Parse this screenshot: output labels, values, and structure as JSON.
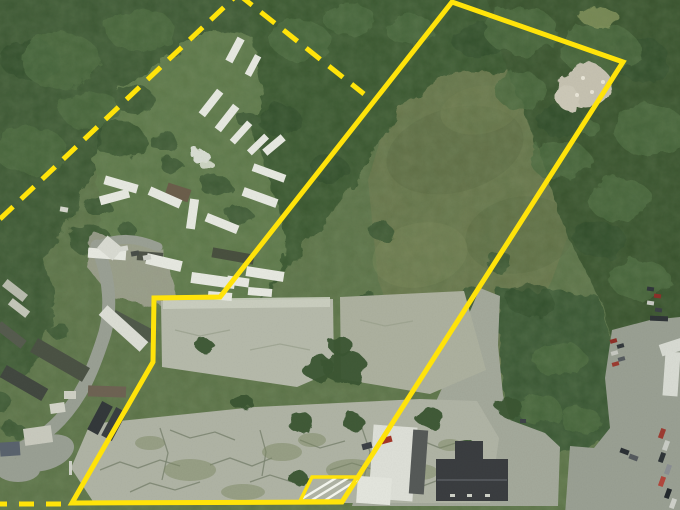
{
  "meta": {
    "width": 680,
    "height": 510,
    "description_name": "aerial-parcel-map"
  },
  "palette": {
    "base_grass": "#5e7449",
    "field_olive": "#6a774c",
    "forest": "#3a5733",
    "forest_dark": "#2c4728",
    "clearing": "#617a4c",
    "pavement_light": "#b6baab",
    "pavement_mid": "#adb19f",
    "pavement_cracked": "#b0b4a5",
    "driveway": "#a4a99b",
    "parking": "#9aa093",
    "road": "#9aa094",
    "boundary_yellow": "#ffe30a",
    "hatch_white": "#f3f5ed",
    "trailer_white": "#e7e9e1",
    "building_dark_roof": "#3a3d40",
    "crack": "#79826e",
    "moss": "#7d8966"
  },
  "scene": {
    "terrain": [
      {
        "name": "field-meadow",
        "pts": "368,180 390,108 445,68 555,66 602,100 588,180 552,280 512,360 478,412 448,398 408,360 378,280",
        "fill": "#6a774c",
        "rough": false,
        "op": 1
      }
    ],
    "field_patches": [
      [
        455,
        150,
        70,
        42,
        -15,
        "#5d6b43",
        0.55
      ],
      [
        520,
        235,
        55,
        38,
        -10,
        "#5a6a42",
        0.45
      ],
      [
        420,
        255,
        48,
        32,
        -12,
        "#788556",
        0.5
      ],
      [
        470,
        330,
        40,
        26,
        -8,
        "#61704a",
        0.5
      ],
      [
        480,
        110,
        40,
        24,
        -10,
        "#717d50",
        0.5
      ]
    ],
    "forest": [
      {
        "name": "forest-top-left",
        "pts": "-20,-20 265,-20 250,40 180,62 150,112 92,170 58,240 28,282 -20,292",
        "fill": "#3a5733"
      },
      {
        "name": "forest-center-band",
        "pts": "250,-20 505,-20 560,28 610,58 600,105 550,70 448,72 400,110 362,170 322,228 285,272 252,302 227,283 246,195 254,118 250,55",
        "fill": "#38552f"
      },
      {
        "name": "forest-right",
        "pts": "480,-20 700,-20 700,322 640,328 612,342 600,300 565,230 535,140 505,60",
        "fill": "#34502c"
      },
      {
        "name": "forest-right-lower",
        "pts": "497,288 598,296 612,345 612,430 588,450 548,452 512,432 500,360",
        "fill": "#375430"
      },
      {
        "name": "forest-left-edge",
        "pts": "-20,240 42,252 56,300 40,360 14,382 -20,372",
        "fill": "#3a5733"
      },
      {
        "name": "clearing-trailer-yard",
        "pts": "120,88 175,52 215,30 252,36 262,92 250,130 268,175 285,235 282,272 248,300 180,308 118,295 95,252 102,205 92,158 108,120",
        "fill": "#617a4c"
      }
    ],
    "canopy_dark": [
      [
        30,
        60,
        30,
        20
      ],
      [
        120,
        140,
        26,
        18
      ],
      [
        480,
        40,
        28,
        18
      ],
      [
        640,
        60,
        30,
        22
      ],
      [
        600,
        240,
        26,
        18
      ],
      [
        530,
        300,
        24,
        16
      ],
      [
        660,
        350,
        22,
        16
      ],
      [
        90,
        240,
        22,
        15
      ],
      [
        280,
        120,
        22,
        15
      ],
      [
        330,
        170,
        20,
        14
      ],
      [
        560,
        120,
        24,
        16
      ]
    ],
    "canopy_light": [
      [
        60,
        60,
        40,
        28
      ],
      [
        140,
        30,
        34,
        22
      ],
      [
        30,
        150,
        36,
        24
      ],
      [
        90,
        110,
        30,
        20
      ],
      [
        520,
        30,
        36,
        24
      ],
      [
        600,
        50,
        40,
        26
      ],
      [
        650,
        130,
        36,
        26
      ],
      [
        620,
        200,
        32,
        22
      ],
      [
        560,
        160,
        30,
        20
      ],
      [
        640,
        280,
        30,
        20
      ],
      [
        520,
        90,
        26,
        18
      ],
      [
        300,
        40,
        30,
        20
      ],
      [
        350,
        20,
        26,
        16
      ],
      [
        410,
        30,
        24,
        16
      ],
      [
        560,
        360,
        26,
        18
      ],
      [
        540,
        410,
        22,
        15
      ],
      [
        580,
        420,
        20,
        14
      ],
      [
        588,
        126,
        10,
        8
      ]
    ],
    "trees_green": [
      [
        135,
        100,
        20,
        14
      ],
      [
        163,
        141,
        14,
        10
      ],
      [
        97,
        206,
        13,
        9
      ],
      [
        249,
        121,
        11,
        8
      ],
      [
        216,
        186,
        15,
        11
      ],
      [
        240,
        216,
        13,
        9
      ],
      [
        172,
        166,
        11,
        8
      ],
      [
        128,
        231,
        9,
        7
      ],
      [
        25,
        300,
        16,
        12
      ],
      [
        14,
        430,
        11,
        8
      ],
      [
        58,
        330,
        10,
        8
      ],
      [
        0,
        402,
        12,
        9
      ],
      [
        380,
        230,
        12,
        9
      ],
      [
        370,
        300,
        11,
        8
      ],
      [
        470,
        300,
        15,
        12
      ],
      [
        500,
        262,
        13,
        10
      ]
    ],
    "dirt_patch": {
      "pts": "95,233 162,248 178,300 150,305 112,298 88,268",
      "fill": "#a4a595",
      "op": 0.85
    },
    "roads": {
      "paths": [
        {
          "d": "M 97,246 C 110,278 113,312 102,342 C 92,372 82,396 60,420 C 44,437 22,450 -5,459",
          "w": 13
        },
        {
          "d": "M 97,246 C 118,236 138,238 158,247",
          "w": 9
        }
      ],
      "pads": [
        [
          45,
          453,
          30,
          17,
          -18
        ],
        [
          18,
          470,
          22,
          12,
          0
        ]
      ]
    },
    "pavement": [
      {
        "name": "driveway-wedge",
        "pts": "480,288 500,296 498,345 503,395 510,420 545,433 560,447 558,506 352,506 363,467 395,440 420,430 433,408 448,375 462,330",
        "fill": "#a4a99b"
      },
      {
        "name": "parking-lot-right",
        "pts": "612,330 650,320 700,315 700,515 565,515 570,446 594,448 610,428 605,378",
        "fill": "#9aa093"
      },
      {
        "name": "pad-upper-right",
        "pts": "340,297 464,291 486,370 430,394 341,379",
        "fill": "#adb19f"
      },
      {
        "name": "pad-upper-left",
        "pts": "161,301 333,299 334,371 297,387 162,367",
        "fill": "#b6baab"
      },
      {
        "name": "pad-bright-edge",
        "pts": "163,299 330,297 330,307 163,309",
        "fill": "#ccd0c1",
        "op": 0.9
      },
      {
        "name": "pad-cracked-lower",
        "pts": "90,424 255,407 420,399 477,401 499,438 490,503 94,503 71,468",
        "fill": "#b0b4a5"
      }
    ],
    "cracks": {
      "color": "#79826e",
      "paths": [
        "M100,470l20,-8 18,6 22,-8 20,6",
        "M130,492l20,-9 25,7 25,-8",
        "M170,430l20,8 25,-6 20,8",
        "M210,465l20,-7 22,8 20,-8",
        "M250,482l20,-7 25,8 23,-7",
        "M300,440l20,8 25,-7",
        "M330,470l22,-7 23,7 23,-7",
        "M370,488l22,-7 23,8 21,-8",
        "M420,440l20,8 22,-7",
        "M440,470l18,-7 20,7",
        "M160,428l8,25 -6,27",
        "M362,428l8,24 -6,26",
        "M260,430l6,22 -4,24"
      ]
    },
    "pad_cracks": {
      "color": "#99a08c",
      "paths": [
        "M175,330l25,6 30,-6",
        "M250,350l30,-6 30,6",
        "M360,320l25,6 28,-5"
      ]
    },
    "moss": [
      [
        190,
        470,
        26,
        11
      ],
      [
        282,
        452,
        20,
        9
      ],
      [
        352,
        470,
        26,
        11
      ],
      [
        150,
        443,
        15,
        7
      ],
      [
        420,
        472,
        18,
        8
      ],
      [
        243,
        492,
        22,
        8
      ],
      [
        312,
        440,
        14,
        7
      ],
      [
        450,
        445,
        12,
        6
      ]
    ],
    "trees_paved": [
      [
        345,
        367,
        22,
        17
      ],
      [
        318,
        368,
        16,
        13
      ],
      [
        300,
        422,
        13,
        10
      ],
      [
        242,
        402,
        11,
        8
      ],
      [
        205,
        346,
        9,
        7
      ],
      [
        510,
        408,
        13,
        10
      ],
      [
        352,
        421,
        11,
        8
      ],
      [
        430,
        418,
        14,
        10
      ],
      [
        467,
        449,
        12,
        9
      ],
      [
        298,
        478,
        10,
        7
      ],
      [
        340,
        345,
        12,
        9
      ]
    ],
    "bare_patches": [
      [
        585,
        85,
        26,
        22,
        "#c6c2b1",
        1
      ],
      [
        568,
        98,
        12,
        11,
        "#cdc9b8",
        1
      ],
      [
        599,
        17,
        20,
        9,
        "#86965f",
        0.8
      ],
      [
        200,
        156,
        9,
        7,
        "#dfe3da",
        0.95
      ],
      [
        207,
        165,
        7,
        5,
        "#d8decf",
        0.9
      ]
    ],
    "bare_dots": [
      [
        583,
        78
      ],
      [
        592,
        92
      ],
      [
        577,
        95
      ],
      [
        603,
        82
      ]
    ],
    "trailers": [
      [
        196,
        99,
        30,
        8,
        -52
      ],
      [
        212,
        114,
        30,
        8,
        -52
      ],
      [
        228,
        129,
        26,
        7,
        -48
      ],
      [
        246,
        141,
        24,
        7,
        -44
      ],
      [
        222,
        46,
        26,
        8,
        -62
      ],
      [
        242,
        62,
        22,
        7,
        -62
      ],
      [
        104,
        180,
        34,
        9,
        16
      ],
      [
        110,
        182,
        9,
        30,
        75
      ],
      [
        148,
        193,
        34,
        9,
        24
      ],
      [
        188,
        199,
        9,
        30,
        8
      ],
      [
        205,
        219,
        34,
        9,
        22
      ],
      [
        242,
        193,
        36,
        9,
        20
      ],
      [
        252,
        169,
        34,
        8,
        20
      ],
      [
        262,
        141,
        24,
        8,
        -40
      ],
      [
        88,
        249,
        38,
        10,
        4
      ],
      [
        146,
        257,
        36,
        11,
        13
      ],
      [
        191,
        275,
        44,
        11,
        8
      ],
      [
        227,
        277,
        22,
        9,
        8
      ],
      [
        208,
        292,
        24,
        8,
        5
      ],
      [
        248,
        288,
        24,
        8,
        5
      ],
      [
        246,
        269,
        38,
        10,
        9
      ]
    ],
    "trailer_striped": [
      96,
      322,
      55,
      13,
      42,
      "#dcded5"
    ],
    "dark_structures": [
      [
        212,
        251,
        42,
        10,
        10,
        "#49503f"
      ],
      [
        166,
        186,
        24,
        13,
        18,
        "#6b5e4b"
      ],
      [
        137,
        252,
        26,
        9,
        4,
        "#4e5348"
      ],
      [
        30,
        352,
        60,
        16,
        30,
        "#4b5244"
      ],
      [
        0,
        376,
        48,
        14,
        30,
        "#424840"
      ],
      [
        110,
        320,
        46,
        13,
        28,
        "#505a4a"
      ],
      [
        -5,
        330,
        32,
        10,
        38,
        "#565c4e"
      ],
      [
        88,
        386,
        38,
        11,
        2,
        "#6e6353"
      ],
      [
        94,
        402,
        12,
        32,
        28,
        "#33383a"
      ],
      [
        108,
        408,
        12,
        32,
        28,
        "#3a3f41"
      ]
    ],
    "houses": [
      [
        24,
        427,
        28,
        17,
        -8,
        "#c9cabe"
      ],
      [
        0,
        442,
        20,
        14,
        -4,
        "#5a636e"
      ],
      [
        50,
        403,
        15,
        10,
        -8,
        "#d3d4c8"
      ],
      [
        64,
        391,
        12,
        8,
        0,
        "#cfd0c4"
      ],
      [
        100,
        240,
        20,
        16,
        40,
        "#d9dbd2"
      ],
      [
        60,
        207,
        8,
        5,
        10,
        "#d5d7cd"
      ],
      [
        2,
        286,
        26,
        9,
        38,
        "#b9bcae"
      ],
      [
        8,
        304,
        22,
        8,
        38,
        "#c4c7b9"
      ]
    ],
    "building_white_parts": [
      [
        371,
        426,
        44,
        74,
        4,
        "#dee0d8"
      ],
      [
        411,
        430,
        15,
        64,
        4,
        "#565a58"
      ],
      [
        357,
        477,
        34,
        27,
        4,
        "#e4e6de"
      ]
    ],
    "building_dark_parts": [
      [
        436,
        459,
        72,
        42,
        0,
        "#3a3d40"
      ],
      [
        455,
        441,
        28,
        26,
        0,
        "#3a3d40"
      ]
    ],
    "building_ridge": [
      437,
      480,
      507,
      480,
      "#5a5e62"
    ],
    "vents": [
      [
        450,
        494,
        5,
        3
      ],
      [
        467,
        494,
        5,
        3
      ],
      [
        485,
        494,
        5,
        3
      ],
      [
        69,
        461,
        3,
        14
      ]
    ],
    "white_structures": [
      [
        660,
        341,
        24,
        12,
        -18,
        "#d8dbd3"
      ],
      [
        664,
        352,
        15,
        44,
        4,
        "#d9dcd4"
      ]
    ],
    "vehicles": [
      [
        120,
        246,
        8,
        5,
        -10,
        "#d8dad2"
      ],
      [
        131,
        251,
        8,
        5,
        -10,
        "#494e49"
      ],
      [
        143,
        255,
        8,
        5,
        -10,
        "#cfd1c9"
      ],
      [
        381,
        437,
        11,
        6,
        -15,
        "#a33527"
      ],
      [
        362,
        443,
        10,
        6,
        -15,
        "#3c4146"
      ],
      [
        610,
        339,
        7,
        4,
        -15,
        "#8e2f27"
      ],
      [
        617,
        344,
        7,
        4,
        -15,
        "#33383c"
      ],
      [
        611,
        351,
        7,
        4,
        -15,
        "#c7c9c1"
      ],
      [
        618,
        357,
        7,
        4,
        -15,
        "#565b5f"
      ],
      [
        612,
        362,
        7,
        4,
        -15,
        "#9b3b30"
      ],
      [
        647,
        287,
        7,
        4,
        8,
        "#31373b"
      ],
      [
        654,
        294,
        7,
        4,
        8,
        "#8d3029"
      ],
      [
        647,
        301,
        7,
        4,
        8,
        "#c9cbc4"
      ],
      [
        655,
        308,
        7,
        4,
        8,
        "#3b4144"
      ],
      [
        650,
        316,
        18,
        5,
        2,
        "#2f3437"
      ],
      [
        657,
        431,
        10,
        5,
        -70,
        "#9d3b31"
      ],
      [
        661,
        443,
        10,
        5,
        -70,
        "#c9ccc5"
      ],
      [
        657,
        455,
        10,
        5,
        -70,
        "#2e3437"
      ],
      [
        663,
        467,
        10,
        5,
        -70,
        "#8b8f93"
      ],
      [
        657,
        479,
        10,
        5,
        -70,
        "#b2473c"
      ],
      [
        663,
        491,
        10,
        5,
        -70,
        "#23282c"
      ],
      [
        668,
        501,
        10,
        5,
        -70,
        "#cfd1ca"
      ],
      [
        620,
        449,
        9,
        5,
        20,
        "#2b3034"
      ],
      [
        629,
        455,
        9,
        5,
        20,
        "#555a5e"
      ],
      [
        520,
        419,
        6,
        4,
        0,
        "#3d4246"
      ]
    ],
    "boundary": {
      "color": "#ffe30a",
      "stroke_width": 5,
      "solid_pts": "452,2 623,62 342,502 72,503 153,362 154,298 220,297",
      "dash_pattern": "18 11",
      "dashed_segments": [
        [
          0,
          219,
          238,
          -6
        ],
        [
          238,
          -6,
          364,
          94
        ]
      ],
      "bottom_dashed": {
        "seg": [
          -8,
          504,
          70,
          504
        ],
        "pattern": "15 12"
      },
      "hatch_area": {
        "pts": "312,477 357,477 342,501 300,501",
        "outline_width": 3.5,
        "hatch_color": "#f3f5ed",
        "hatch_width": 2.4,
        "lines": [
          [
            300,
            500,
            336,
            478
          ],
          [
            312,
            500,
            348,
            478
          ],
          [
            324,
            501,
            357,
            480
          ]
        ]
      }
    }
  }
}
